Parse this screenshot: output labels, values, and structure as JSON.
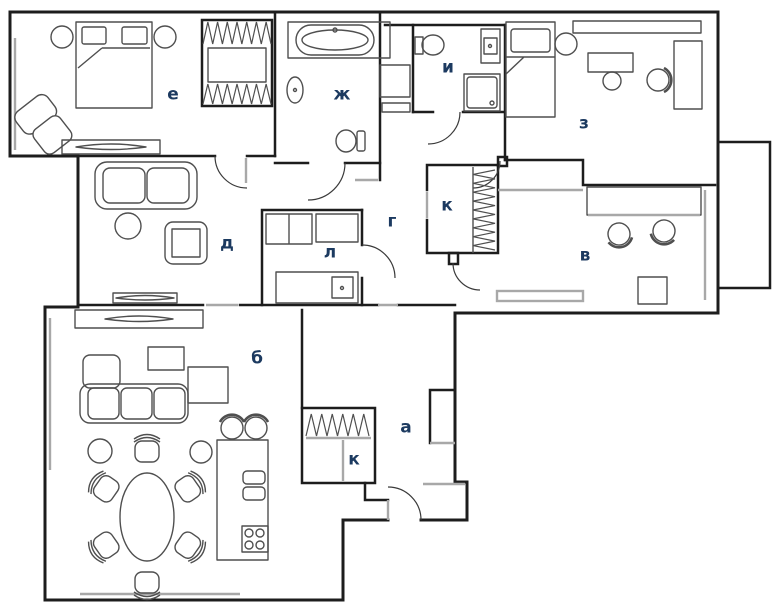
{
  "floorplan": {
    "background": "#ffffff",
    "wall_color": "#1d1d1d",
    "furniture_color": "#4f4f4f",
    "accent_color": "#a8a8a8",
    "label_color": "#1c3a60",
    "rooms": [
      {
        "id": "e",
        "label": "е",
        "x": 173,
        "y": 95,
        "furniture": [
          "double-bed",
          "bedside-lamps",
          "wardrobe",
          "armchair",
          "tv-console"
        ]
      },
      {
        "id": "zh",
        "label": "ж",
        "x": 342,
        "y": 95,
        "furniture": [
          "bathtub",
          "sink",
          "toilet"
        ]
      },
      {
        "id": "i",
        "label": "и",
        "x": 448,
        "y": 68,
        "furniture": [
          "toilet",
          "washing-machine",
          "shower"
        ]
      },
      {
        "id": "z",
        "label": "з",
        "x": 584,
        "y": 124,
        "furniture": [
          "single-bed",
          "round-stool",
          "desk",
          "office-chair",
          "cabinet"
        ]
      },
      {
        "id": "d",
        "label": "д",
        "x": 227,
        "y": 244,
        "furniture": [
          "sofa",
          "round-table",
          "armchair",
          "tv-console"
        ]
      },
      {
        "id": "g",
        "label": "г",
        "x": 392,
        "y": 222,
        "furniture": []
      },
      {
        "id": "k1",
        "label": "к",
        "x": 447,
        "y": 206,
        "furniture": [
          "wardrobe"
        ]
      },
      {
        "id": "v",
        "label": "в",
        "x": 585,
        "y": 256,
        "furniture": [
          "desk",
          "office-chairs",
          "radiator"
        ]
      },
      {
        "id": "l",
        "label": "л",
        "x": 330,
        "y": 253,
        "furniture": [
          "shelving",
          "cabinet"
        ]
      },
      {
        "id": "b",
        "label": "б",
        "x": 257,
        "y": 359,
        "furniture": [
          "corner-sofa",
          "coffee-table",
          "poufs",
          "dining-table",
          "dining-chairs",
          "kitchen-island",
          "bar-stools",
          "tv-console"
        ]
      },
      {
        "id": "a",
        "label": "а",
        "x": 406,
        "y": 428,
        "furniture": []
      },
      {
        "id": "k2",
        "label": "к",
        "x": 354,
        "y": 460,
        "furniture": [
          "wardrobe"
        ]
      }
    ]
  }
}
